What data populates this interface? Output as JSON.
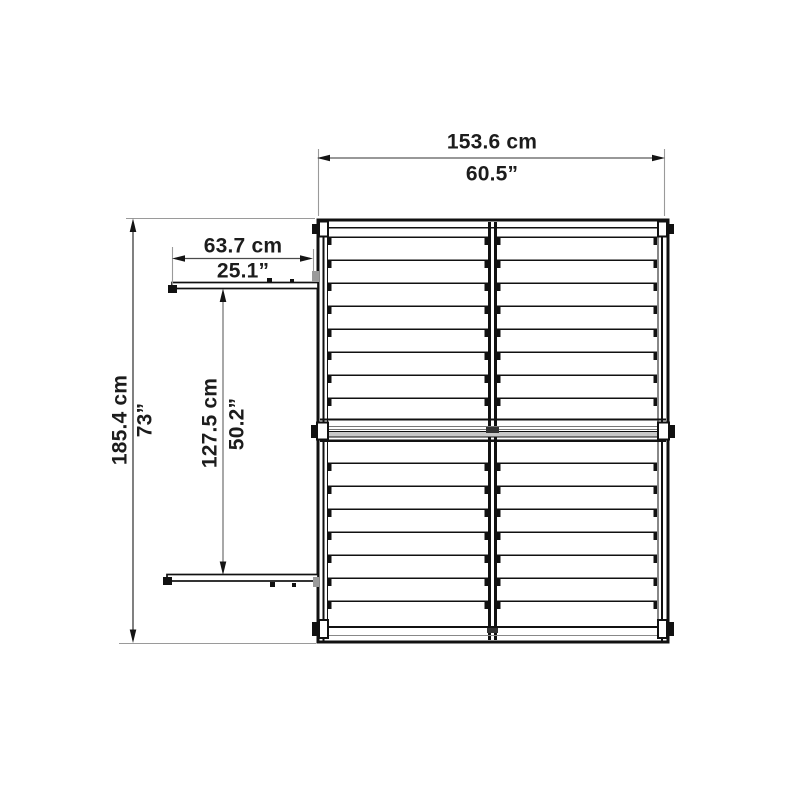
{
  "diagram": {
    "type": "technical-dimension-drawing",
    "subject": "shed roof top view with sliding door rails",
    "background": "#ffffff",
    "colors": {
      "structure_line": "#111111",
      "dimension_line": "#4a4a4a",
      "inner_dimension_line": "#7a7a7a",
      "extension_line": "#9a9a9a",
      "ridge_fill": "#c8c8c8",
      "text": "#1c1c1c"
    },
    "units": [
      "cm",
      "inches"
    ],
    "dimensions": {
      "overall_width": {
        "cm": "153.6 cm",
        "inch": "60.5”"
      },
      "overall_depth": {
        "cm": "185.4 cm",
        "inch": "73”"
      },
      "rail_length": {
        "cm": "63.7 cm",
        "inch": "25.1”"
      },
      "rail_spacing": {
        "cm": "127.5 cm",
        "inch": "50.2”"
      }
    }
  }
}
